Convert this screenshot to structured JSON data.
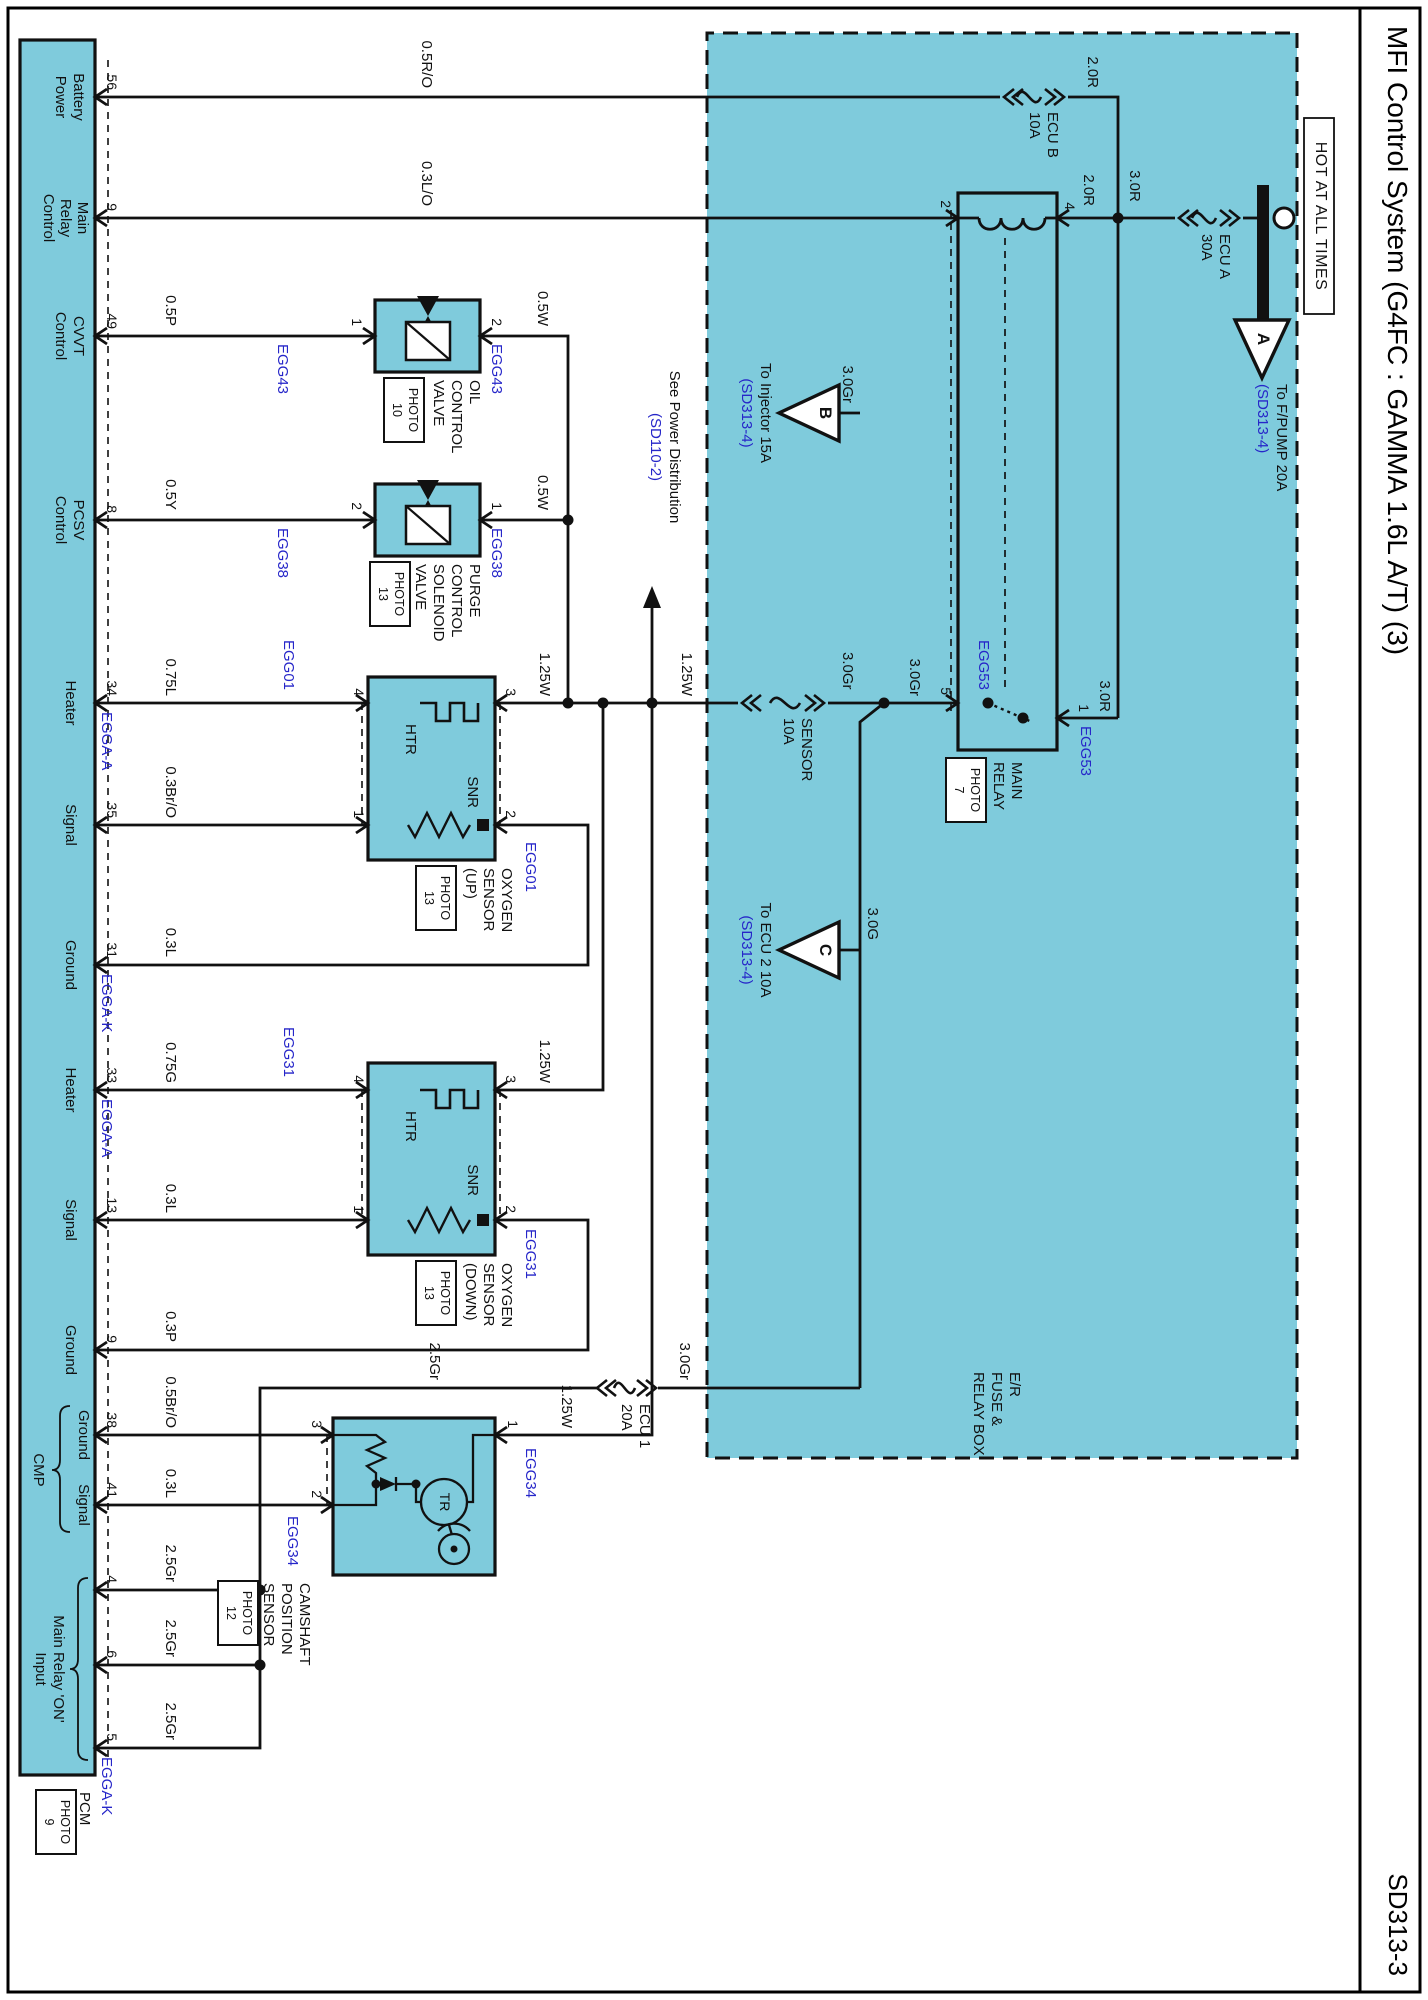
{
  "page": {
    "title": "MFI Control System (G4FC : GAMMA 1.6L A/T) (3)",
    "code": "SD313-3"
  },
  "colors": {
    "cyan": "#7fcbdc",
    "blue_text": "#2626c9",
    "line": "#111111"
  },
  "icons": [
    {
      "name": "fuse-icon",
      "meaning": "fuse element (squiggle with chevrons)"
    },
    {
      "name": "relay-coil-icon",
      "meaning": "relay coil bumps"
    },
    {
      "name": "heater-element-icon",
      "meaning": "HTR square-wave heater"
    },
    {
      "name": "resistor-icon",
      "meaning": "SNR zigzag resistor"
    },
    {
      "name": "solenoid-valve-icon",
      "meaning": "valve box with diagonal and bowtie"
    },
    {
      "name": "ground-bus-bar-icon",
      "meaning": "battery feed bus bar with terminal circle"
    },
    {
      "name": "offpage-arrow-icon",
      "meaning": "triangle off-page connector"
    }
  ],
  "texts": [
    {
      "n": "hot-at-all-times-label",
      "t": "HOT AT ALL TIMES",
      "x": 216,
      "y": 99,
      "a": "c",
      "c": "hot"
    },
    {
      "n": "offpage-connector-a",
      "t": "A",
      "x": 339,
      "y": 156,
      "a": "c",
      "c": "tri"
    },
    {
      "n": "to-fpump-label",
      "t": "To F/PUMP 20A",
      "x": 384,
      "y": 139,
      "a": "l"
    },
    {
      "n": "to-fpump-ref",
      "t": "(SD313-4)",
      "x": 384,
      "y": 158,
      "a": "l",
      "c": "b"
    },
    {
      "n": "fuse-name",
      "t": "ECU A",
      "x": 234,
      "y": 196,
      "a": "l"
    },
    {
      "n": "fuse-rating",
      "t": "30A",
      "x": 234,
      "y": 214,
      "a": "l"
    },
    {
      "n": "wire-label",
      "t": "3.0R",
      "x": 186,
      "y": 286,
      "a": "c"
    },
    {
      "n": "wire-label",
      "t": "2.0R",
      "x": 88,
      "y": 328,
      "a": "r"
    },
    {
      "n": "fuse-name",
      "t": "ECU B",
      "x": 112,
      "y": 368,
      "a": "l"
    },
    {
      "n": "fuse-rating",
      "t": "10A",
      "x": 112,
      "y": 386,
      "a": "l"
    },
    {
      "n": "wire-label",
      "t": "2.0R",
      "x": 206,
      "y": 332,
      "a": "r"
    },
    {
      "n": "relay-pin-number",
      "t": "4",
      "x": 210,
      "y": 351,
      "a": "r",
      "c": "n"
    },
    {
      "n": "wire-label",
      "t": "3.0R",
      "x": 712,
      "y": 316,
      "a": "r"
    },
    {
      "n": "relay-pin-number",
      "t": "1",
      "x": 712,
      "y": 337,
      "a": "r",
      "c": "n"
    },
    {
      "n": "connector-code",
      "t": "EGG53",
      "x": 726,
      "y": 335,
      "a": "l",
      "c": "b"
    },
    {
      "n": "relay-pin-number",
      "t": "2",
      "x": 208,
      "y": 475,
      "a": "r",
      "c": "n"
    },
    {
      "n": "relay-pin-number",
      "t": "5",
      "x": 695,
      "y": 475,
      "a": "r",
      "c": "n"
    },
    {
      "n": "connector-code",
      "t": "EGG53",
      "x": 690,
      "y": 437,
      "a": "r",
      "c": "b"
    },
    {
      "n": "component-name",
      "t": "MAIN",
      "x": 762,
      "y": 404,
      "a": "l"
    },
    {
      "n": "component-name",
      "t": "RELAY",
      "x": 762,
      "y": 422,
      "a": "l"
    },
    {
      "n": "photo-ref",
      "t": "PHOTO",
      "x": 790,
      "y": 447,
      "a": "c",
      "c": "ph"
    },
    {
      "n": "photo-ref",
      "t": "7",
      "x": 790,
      "y": 463,
      "a": "c",
      "c": "ph"
    },
    {
      "n": "fuse-name",
      "t": "SENSOR",
      "x": 718,
      "y": 614,
      "a": "l"
    },
    {
      "n": "fuse-rating",
      "t": "10A",
      "x": 718,
      "y": 632,
      "a": "l"
    },
    {
      "n": "wire-label",
      "t": "3.0Gr",
      "x": 696,
      "y": 506,
      "a": "r"
    },
    {
      "n": "wire-label",
      "t": "3.0Gr",
      "x": 652,
      "y": 573,
      "a": "l"
    },
    {
      "n": "wire-label",
      "t": "3.0Gr",
      "x": 403,
      "y": 573,
      "a": "r"
    },
    {
      "n": "offpage-connector-b",
      "t": "B",
      "x": 413,
      "y": 594,
      "a": "c",
      "c": "tri"
    },
    {
      "n": "to-injector-label",
      "t": "To Injector 15A",
      "x": 413,
      "y": 655,
      "a": "c"
    },
    {
      "n": "to-injector-ref",
      "t": "(SD313-4)",
      "x": 413,
      "y": 674,
      "a": "c",
      "c": "b"
    },
    {
      "n": "wire-label",
      "t": "3.0G",
      "x": 940,
      "y": 548,
      "a": "r"
    },
    {
      "n": "offpage-connector-c",
      "t": "C",
      "x": 950,
      "y": 594,
      "a": "c",
      "c": "tri"
    },
    {
      "n": "to-ecu2-label",
      "t": "To ECU 2 10A",
      "x": 950,
      "y": 655,
      "a": "c"
    },
    {
      "n": "to-ecu2-ref",
      "t": "(SD313-4)",
      "x": 950,
      "y": 674,
      "a": "c",
      "c": "b"
    },
    {
      "n": "see-power-distribution-label",
      "t": "See Power Distribution",
      "x": 447,
      "y": 746,
      "a": "c"
    },
    {
      "n": "see-power-distribution-ref",
      "t": "(SD110-2)",
      "x": 447,
      "y": 765,
      "a": "c",
      "c": "b"
    },
    {
      "n": "fusebox-name",
      "t": "E/R",
      "x": 1372,
      "y": 406,
      "a": "l"
    },
    {
      "n": "fusebox-name",
      "t": "FUSE &",
      "x": 1372,
      "y": 424,
      "a": "l"
    },
    {
      "n": "fusebox-name",
      "t": "RELAY BOX",
      "x": 1372,
      "y": 442,
      "a": "l"
    },
    {
      "n": "wire-label",
      "t": "0.5R/O",
      "x": 88,
      "y": 994,
      "a": "r"
    },
    {
      "n": "wire-label",
      "t": "0.3L/O",
      "x": 206,
      "y": 994,
      "a": "r"
    },
    {
      "n": "wire-label",
      "t": "0.5W",
      "x": 326,
      "y": 878,
      "a": "r"
    },
    {
      "n": "wire-label",
      "t": "0.5W",
      "x": 510,
      "y": 878,
      "a": "r"
    },
    {
      "n": "component-pin-number",
      "t": "2",
      "x": 326,
      "y": 924,
      "a": "r",
      "c": "n"
    },
    {
      "n": "connector-code",
      "t": "EGG43",
      "x": 344,
      "y": 924,
      "a": "l",
      "c": "b"
    },
    {
      "n": "component-pin-number",
      "t": "1",
      "x": 326,
      "y": 1064,
      "a": "r",
      "c": "n"
    },
    {
      "n": "connector-code",
      "t": "EGG43",
      "x": 344,
      "y": 1138,
      "a": "l",
      "c": "b"
    },
    {
      "n": "component-name",
      "t": "OIL",
      "x": 380,
      "y": 946,
      "a": "l"
    },
    {
      "n": "component-name",
      "t": "CONTROL",
      "x": 380,
      "y": 964,
      "a": "l"
    },
    {
      "n": "component-name",
      "t": "VALVE",
      "x": 380,
      "y": 982,
      "a": "l"
    },
    {
      "n": "photo-ref",
      "t": "PHOTO",
      "x": 410,
      "y": 1009,
      "a": "c",
      "c": "ph"
    },
    {
      "n": "photo-ref",
      "t": "10",
      "x": 410,
      "y": 1025,
      "a": "c",
      "c": "ph"
    },
    {
      "n": "wire-label",
      "t": "0.5P",
      "x": 326,
      "y": 1250,
      "a": "r"
    },
    {
      "n": "component-pin-number",
      "t": "1",
      "x": 510,
      "y": 924,
      "a": "r",
      "c": "n"
    },
    {
      "n": "connector-code",
      "t": "EGG38",
      "x": 528,
      "y": 924,
      "a": "l",
      "c": "b"
    },
    {
      "n": "component-pin-number",
      "t": "2",
      "x": 510,
      "y": 1064,
      "a": "r",
      "c": "n"
    },
    {
      "n": "connector-code",
      "t": "EGG38",
      "x": 528,
      "y": 1138,
      "a": "l",
      "c": "b"
    },
    {
      "n": "component-name",
      "t": "PURGE",
      "x": 564,
      "y": 946,
      "a": "l"
    },
    {
      "n": "component-name",
      "t": "CONTROL",
      "x": 564,
      "y": 964,
      "a": "l"
    },
    {
      "n": "component-name",
      "t": "SOLENOID",
      "x": 564,
      "y": 982,
      "a": "l"
    },
    {
      "n": "component-name",
      "t": "VALVE",
      "x": 564,
      "y": 1000,
      "a": "l"
    },
    {
      "n": "photo-ref",
      "t": "PHOTO",
      "x": 594,
      "y": 1023,
      "a": "c",
      "c": "ph"
    },
    {
      "n": "photo-ref",
      "t": "13",
      "x": 594,
      "y": 1039,
      "a": "c",
      "c": "ph"
    },
    {
      "n": "wire-label",
      "t": "0.5Y",
      "x": 510,
      "y": 1250,
      "a": "r"
    },
    {
      "n": "wire-label",
      "t": "1.25W",
      "x": 696,
      "y": 734,
      "a": "r"
    },
    {
      "n": "wire-label",
      "t": "1.25W",
      "x": 696,
      "y": 876,
      "a": "r"
    },
    {
      "n": "component-pin-number",
      "t": "3",
      "x": 696,
      "y": 910,
      "a": "r",
      "c": "n"
    },
    {
      "n": "component-pin-number",
      "t": "2",
      "x": 818,
      "y": 910,
      "a": "r",
      "c": "n"
    },
    {
      "n": "connector-code",
      "t": "EGG01",
      "x": 842,
      "y": 890,
      "a": "l",
      "c": "b"
    },
    {
      "n": "component-pin-number",
      "t": "4",
      "x": 696,
      "y": 1062,
      "a": "r",
      "c": "n"
    },
    {
      "n": "component-pin-number",
      "t": "1",
      "x": 818,
      "y": 1062,
      "a": "r",
      "c": "n"
    },
    {
      "n": "connector-code",
      "t": "EGG01",
      "x": 640,
      "y": 1132,
      "a": "l",
      "c": "b"
    },
    {
      "n": "element-label",
      "t": "HTR",
      "x": 724,
      "y": 1010,
      "a": "l"
    },
    {
      "n": "element-label",
      "t": "SNR",
      "x": 808,
      "y": 948,
      "a": "r"
    },
    {
      "n": "component-name",
      "t": "OXYGEN",
      "x": 868,
      "y": 914,
      "a": "l"
    },
    {
      "n": "component-name",
      "t": "SENSOR",
      "x": 868,
      "y": 932,
      "a": "l"
    },
    {
      "n": "component-name",
      "t": "(UP)",
      "x": 868,
      "y": 950,
      "a": "l"
    },
    {
      "n": "photo-ref",
      "t": "PHOTO",
      "x": 898,
      "y": 977,
      "a": "c",
      "c": "ph"
    },
    {
      "n": "photo-ref",
      "t": "13",
      "x": 898,
      "y": 993,
      "a": "c",
      "c": "ph"
    },
    {
      "n": "wire-label",
      "t": "0.75L",
      "x": 696,
      "y": 1250,
      "a": "r"
    },
    {
      "n": "wire-label",
      "t": "0.3Br/O",
      "x": 818,
      "y": 1250,
      "a": "r"
    },
    {
      "n": "wire-label",
      "t": "0.3L",
      "x": 957,
      "y": 1250,
      "a": "r"
    },
    {
      "n": "wire-label",
      "t": "1.25W",
      "x": 1083,
      "y": 876,
      "a": "r"
    },
    {
      "n": "component-pin-number",
      "t": "3",
      "x": 1083,
      "y": 910,
      "a": "r",
      "c": "n"
    },
    {
      "n": "component-pin-number",
      "t": "2",
      "x": 1213,
      "y": 910,
      "a": "r",
      "c": "n"
    },
    {
      "n": "connector-code",
      "t": "EGG31",
      "x": 1229,
      "y": 890,
      "a": "l",
      "c": "b"
    },
    {
      "n": "component-pin-number",
      "t": "4",
      "x": 1083,
      "y": 1062,
      "a": "r",
      "c": "n"
    },
    {
      "n": "component-pin-number",
      "t": "1",
      "x": 1213,
      "y": 1062,
      "a": "r",
      "c": "n"
    },
    {
      "n": "connector-code",
      "t": "EGG31",
      "x": 1027,
      "y": 1132,
      "a": "l",
      "c": "b"
    },
    {
      "n": "element-label",
      "t": "HTR",
      "x": 1111,
      "y": 1010,
      "a": "l"
    },
    {
      "n": "element-label",
      "t": "SNR",
      "x": 1196,
      "y": 948,
      "a": "r"
    },
    {
      "n": "component-name",
      "t": "OXYGEN",
      "x": 1263,
      "y": 914,
      "a": "l"
    },
    {
      "n": "component-name",
      "t": "SENSOR",
      "x": 1263,
      "y": 932,
      "a": "l"
    },
    {
      "n": "component-name",
      "t": "(DOWN)",
      "x": 1263,
      "y": 950,
      "a": "l"
    },
    {
      "n": "photo-ref",
      "t": "PHOTO",
      "x": 1293,
      "y": 977,
      "a": "c",
      "c": "ph"
    },
    {
      "n": "photo-ref",
      "t": "13",
      "x": 1293,
      "y": 993,
      "a": "c",
      "c": "ph"
    },
    {
      "n": "wire-label",
      "t": "0.75G",
      "x": 1083,
      "y": 1250,
      "a": "r"
    },
    {
      "n": "wire-label",
      "t": "0.3L",
      "x": 1213,
      "y": 1250,
      "a": "r"
    },
    {
      "n": "wire-label",
      "t": "0.3P",
      "x": 1342,
      "y": 1250,
      "a": "r"
    },
    {
      "n": "wire-label",
      "t": "1.25W",
      "x": 1428,
      "y": 854,
      "a": "r"
    },
    {
      "n": "component-pin-number",
      "t": "1",
      "x": 1428,
      "y": 908,
      "a": "r",
      "c": "n"
    },
    {
      "n": "connector-code",
      "t": "EGG34",
      "x": 1448,
      "y": 890,
      "a": "l",
      "c": "b"
    },
    {
      "n": "element-label",
      "t": "TR",
      "x": 1502,
      "y": 976,
      "a": "c",
      "c": "n"
    },
    {
      "n": "component-pin-number",
      "t": "3",
      "x": 1428,
      "y": 1104,
      "a": "r",
      "c": "n"
    },
    {
      "n": "component-pin-number",
      "t": "2",
      "x": 1498,
      "y": 1104,
      "a": "r",
      "c": "n"
    },
    {
      "n": "connector-code",
      "t": "EGG34",
      "x": 1516,
      "y": 1128,
      "a": "l",
      "c": "b"
    },
    {
      "n": "component-name",
      "t": "CAMSHAFT",
      "x": 1583,
      "y": 1116,
      "a": "l"
    },
    {
      "n": "component-name",
      "t": "POSITION",
      "x": 1583,
      "y": 1134,
      "a": "l"
    },
    {
      "n": "component-name",
      "t": "SENSOR",
      "x": 1583,
      "y": 1152,
      "a": "l"
    },
    {
      "n": "photo-ref",
      "t": "PHOTO",
      "x": 1613,
      "y": 1175,
      "a": "c",
      "c": "ph"
    },
    {
      "n": "photo-ref",
      "t": "12",
      "x": 1613,
      "y": 1191,
      "a": "c",
      "c": "ph"
    },
    {
      "n": "wire-label",
      "t": "0.5Br/O",
      "x": 1428,
      "y": 1250,
      "a": "r"
    },
    {
      "n": "wire-label",
      "t": "0.3L",
      "x": 1498,
      "y": 1250,
      "a": "r"
    },
    {
      "n": "wire-label",
      "t": "3.0Gr",
      "x": 1380,
      "y": 736,
      "a": "r"
    },
    {
      "n": "fuse-name",
      "t": "ECU 1",
      "x": 1404,
      "y": 776,
      "a": "l"
    },
    {
      "n": "fuse-rating",
      "t": "20A",
      "x": 1404,
      "y": 794,
      "a": "l"
    },
    {
      "n": "wire-label",
      "t": "2.5Gr",
      "x": 1380,
      "y": 986,
      "a": "r"
    },
    {
      "n": "wire-label",
      "t": "2.5Gr",
      "x": 1582,
      "y": 1250,
      "a": "r"
    },
    {
      "n": "wire-label",
      "t": "2.5Gr",
      "x": 1657,
      "y": 1250,
      "a": "r"
    },
    {
      "n": "wire-label",
      "t": "2.5Gr",
      "x": 1740,
      "y": 1250,
      "a": "r"
    },
    {
      "n": "pcm-pin-number",
      "t": "56",
      "x": 90,
      "y": 1309,
      "a": "r",
      "c": "n"
    },
    {
      "n": "pcm-pin-number",
      "t": "9",
      "x": 211,
      "y": 1309,
      "a": "r",
      "c": "n"
    },
    {
      "n": "pcm-pin-number",
      "t": "49",
      "x": 329,
      "y": 1309,
      "a": "r",
      "c": "n"
    },
    {
      "n": "pcm-pin-number",
      "t": "8",
      "x": 513,
      "y": 1309,
      "a": "r",
      "c": "n"
    },
    {
      "n": "pcm-pin-number",
      "t": "34",
      "x": 696,
      "y": 1309,
      "a": "r",
      "c": "n"
    },
    {
      "n": "pcm-pin-number",
      "t": "35",
      "x": 818,
      "y": 1309,
      "a": "r",
      "c": "n"
    },
    {
      "n": "pcm-pin-number",
      "t": "31",
      "x": 958,
      "y": 1309,
      "a": "r",
      "c": "n"
    },
    {
      "n": "pcm-pin-number",
      "t": "33",
      "x": 1083,
      "y": 1309,
      "a": "r",
      "c": "n"
    },
    {
      "n": "pcm-pin-number",
      "t": "13",
      "x": 1213,
      "y": 1309,
      "a": "r",
      "c": "n"
    },
    {
      "n": "pcm-pin-number",
      "t": "9",
      "x": 1343,
      "y": 1309,
      "a": "r",
      "c": "n"
    },
    {
      "n": "pcm-pin-number",
      "t": "38",
      "x": 1428,
      "y": 1309,
      "a": "r",
      "c": "n"
    },
    {
      "n": "pcm-pin-number",
      "t": "41",
      "x": 1498,
      "y": 1309,
      "a": "r",
      "c": "n"
    },
    {
      "n": "pcm-pin-number",
      "t": "4",
      "x": 1583,
      "y": 1309,
      "a": "r",
      "c": "n"
    },
    {
      "n": "pcm-pin-number",
      "t": "6",
      "x": 1658,
      "y": 1309,
      "a": "r",
      "c": "n"
    },
    {
      "n": "pcm-pin-number",
      "t": "5",
      "x": 1741,
      "y": 1309,
      "a": "r",
      "c": "n"
    },
    {
      "n": "connector-code",
      "t": "EGGA-A",
      "x": 712,
      "y": 1314,
      "a": "l",
      "c": "b"
    },
    {
      "n": "connector-code",
      "t": "EGGA-K",
      "x": 974,
      "y": 1314,
      "a": "l",
      "c": "b"
    },
    {
      "n": "connector-code",
      "t": "EGGA-A",
      "x": 1099,
      "y": 1314,
      "a": "l",
      "c": "b"
    },
    {
      "n": "connector-code",
      "t": "EGGA-K",
      "x": 1757,
      "y": 1314,
      "a": "l",
      "c": "b"
    },
    {
      "n": "pcm-pin-label",
      "t": "Battery",
      "x": 97,
      "y": 1342,
      "a": "c"
    },
    {
      "n": "pcm-pin-label",
      "t": "Power",
      "x": 97,
      "y": 1360,
      "a": "c"
    },
    {
      "n": "pcm-pin-label",
      "t": "Main",
      "x": 218,
      "y": 1338,
      "a": "c"
    },
    {
      "n": "pcm-pin-label",
      "t": "Relay",
      "x": 218,
      "y": 1355,
      "a": "c"
    },
    {
      "n": "pcm-pin-label",
      "t": "Control",
      "x": 218,
      "y": 1372,
      "a": "c"
    },
    {
      "n": "pcm-pin-label",
      "t": "CVVT",
      "x": 336,
      "y": 1342,
      "a": "c"
    },
    {
      "n": "pcm-pin-label",
      "t": "Control",
      "x": 336,
      "y": 1360,
      "a": "c"
    },
    {
      "n": "pcm-pin-label",
      "t": "PCSV",
      "x": 520,
      "y": 1342,
      "a": "c"
    },
    {
      "n": "pcm-pin-label",
      "t": "Control",
      "x": 520,
      "y": 1360,
      "a": "c"
    },
    {
      "n": "pcm-pin-label",
      "t": "Heater",
      "x": 703,
      "y": 1350,
      "a": "c"
    },
    {
      "n": "pcm-pin-label",
      "t": "Signal",
      "x": 825,
      "y": 1350,
      "a": "c"
    },
    {
      "n": "pcm-pin-label",
      "t": "Ground",
      "x": 965,
      "y": 1350,
      "a": "c"
    },
    {
      "n": "pcm-pin-label",
      "t": "Heater",
      "x": 1090,
      "y": 1350,
      "a": "c"
    },
    {
      "n": "pcm-pin-label",
      "t": "Signal",
      "x": 1220,
      "y": 1350,
      "a": "c"
    },
    {
      "n": "pcm-pin-label",
      "t": "Ground",
      "x": 1350,
      "y": 1350,
      "a": "c"
    },
    {
      "n": "pcm-pin-label",
      "t": "Ground",
      "x": 1435,
      "y": 1337,
      "a": "c"
    },
    {
      "n": "pcm-pin-label",
      "t": "Signal",
      "x": 1505,
      "y": 1337,
      "a": "c"
    },
    {
      "n": "pcm-group-label",
      "t": "CMP",
      "x": 1470,
      "y": 1382,
      "a": "c"
    },
    {
      "n": "pcm-group-label",
      "t": "Main Relay 'ON'",
      "x": 1669,
      "y": 1362,
      "a": "c"
    },
    {
      "n": "pcm-group-label",
      "t": "Input",
      "x": 1669,
      "y": 1380,
      "a": "c"
    },
    {
      "n": "pcm-name",
      "t": "PCM",
      "x": 1792,
      "y": 1336,
      "a": "l"
    },
    {
      "n": "photo-ref",
      "t": "PHOTO",
      "x": 1822,
      "y": 1357,
      "a": "c",
      "c": "ph"
    },
    {
      "n": "photo-ref",
      "t": "9",
      "x": 1822,
      "y": 1373,
      "a": "c",
      "c": "ph"
    }
  ]
}
